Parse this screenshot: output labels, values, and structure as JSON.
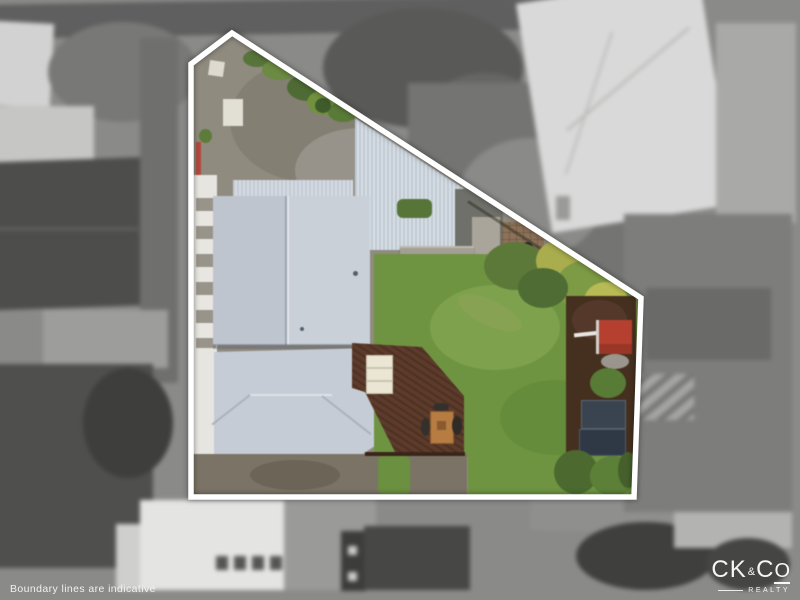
{
  "photo": {
    "kind": "aerial-drone-property-photo",
    "boundary_points": "232,33 641,298 634,497 191,497 191,64",
    "palette": {
      "boundary_line": "#ffffff",
      "lawn_green": "#6f9441",
      "roof_grey_blue": "#cad0d8",
      "carport_blue": "#c7d1dc",
      "deck_brown": "#5d3b2b",
      "mulch_brown": "#45301f",
      "kennel_red": "#b5402f",
      "utility_red": "#c23b2d",
      "concrete": "#8f8b7f",
      "background_grey": "#8e8e8c"
    }
  },
  "footer": {
    "disclaimer": "Boundary lines are indicative"
  },
  "brand": {
    "ck": "CK",
    "amp": "&",
    "c": "C",
    "o": "O",
    "realty": "REALTY"
  }
}
